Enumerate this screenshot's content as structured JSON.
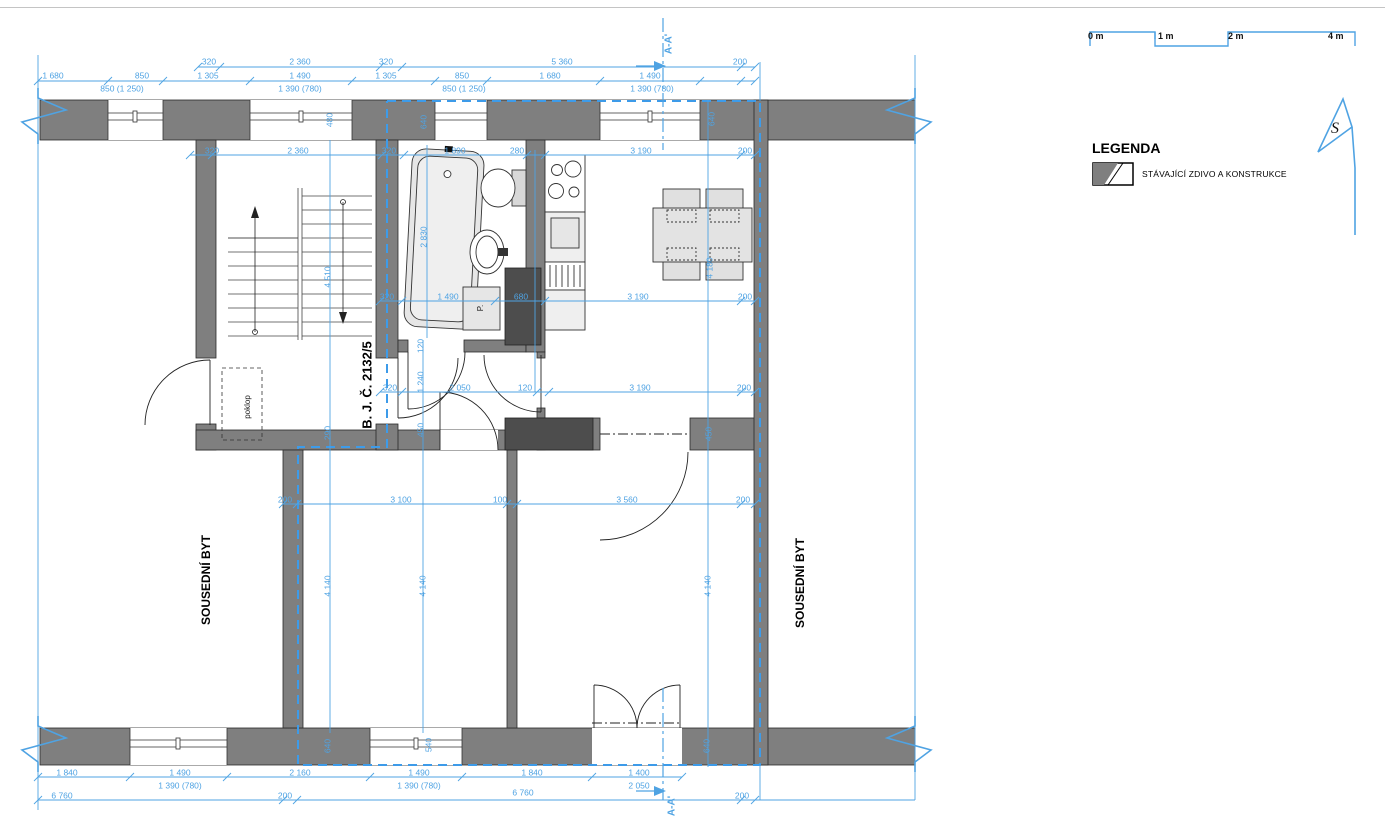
{
  "colors": {
    "dimension": "#4FA3E3",
    "boundary": "#3D9BE9",
    "wall": "#7F7F7F",
    "wall_dark": "#4D4D4D",
    "furniture": "#E6E6E6",
    "line": "#1A1A1A"
  },
  "legend": {
    "title": "LEGENDA",
    "items": [
      {
        "label": "STÁVAJÍCÍ ZDIVO A KONSTRUKCE",
        "swatch": "existing-masonry"
      }
    ]
  },
  "scale_bar": {
    "ticks": [
      "0 m",
      "1 m",
      "2 m",
      "4 m"
    ]
  },
  "north": {
    "label": "S"
  },
  "section_marker": {
    "top": "A-A'",
    "bottom": "A-A'"
  },
  "plan_labels": [
    {
      "id": "unit-number",
      "text": "B. J. Č. 2132/5",
      "x": 368,
      "y": 385,
      "r": -90,
      "size": 13,
      "weight": "bold",
      "color": "#000"
    },
    {
      "id": "neighbor-left",
      "text": "SOUSEDNÍ BYT",
      "x": 207,
      "y": 580,
      "r": -90,
      "size": 12,
      "weight": "bold",
      "color": "#000"
    },
    {
      "id": "neighbor-right",
      "text": "SOUSEDNÍ BYT",
      "x": 801,
      "y": 583,
      "r": -90,
      "size": 12,
      "weight": "bold",
      "color": "#000"
    },
    {
      "id": "hatch",
      "text": "poklop",
      "x": 248,
      "y": 407,
      "r": -90,
      "size": 8,
      "weight": "normal",
      "color": "#222"
    },
    {
      "id": "washing-machine",
      "text": "P.",
      "x": 481,
      "y": 308,
      "r": -90,
      "size": 8,
      "weight": "normal",
      "color": "#222"
    },
    {
      "id": "section-top",
      "text": "A-A'",
      "x": 669,
      "y": 44,
      "r": -90,
      "size": 10,
      "weight": "bold",
      "color": "#4FA3E3"
    },
    {
      "id": "section-bottom",
      "text": "A-A'",
      "x": 672,
      "y": 806,
      "r": -90,
      "size": 10,
      "weight": "bold",
      "color": "#4FA3E3"
    }
  ],
  "dimensions": [
    {
      "t": "320",
      "x": 209,
      "y": 62
    },
    {
      "t": "2 360",
      "x": 300,
      "y": 62
    },
    {
      "t": "320",
      "x": 386,
      "y": 62
    },
    {
      "t": "5 360",
      "x": 562,
      "y": 62
    },
    {
      "t": "200",
      "x": 740,
      "y": 62
    },
    {
      "t": "1 680",
      "x": 53,
      "y": 76
    },
    {
      "t": "850",
      "x": 142,
      "y": 76
    },
    {
      "t": "1 305",
      "x": 208,
      "y": 76
    },
    {
      "t": "1 490",
      "x": 300,
      "y": 76
    },
    {
      "t": "1 305",
      "x": 386,
      "y": 76
    },
    {
      "t": "850",
      "x": 462,
      "y": 76
    },
    {
      "t": "1 680",
      "x": 550,
      "y": 76
    },
    {
      "t": "1 490",
      "x": 650,
      "y": 76
    },
    {
      "t": "850 (1 250)",
      "x": 122,
      "y": 89
    },
    {
      "t": "1 390 (780)",
      "x": 300,
      "y": 89
    },
    {
      "t": "850 (1 250)",
      "x": 464,
      "y": 89
    },
    {
      "t": "1 390 (780)",
      "x": 652,
      "y": 89
    },
    {
      "t": "320",
      "x": 212,
      "y": 151
    },
    {
      "t": "2 360",
      "x": 298,
      "y": 151
    },
    {
      "t": "320",
      "x": 389,
      "y": 151
    },
    {
      "t": "1 890",
      "x": 455,
      "y": 151
    },
    {
      "t": "280",
      "x": 517,
      "y": 151
    },
    {
      "t": "3 190",
      "x": 641,
      "y": 151
    },
    {
      "t": "200",
      "x": 745,
      "y": 151
    },
    {
      "t": "480",
      "x": 330,
      "y": 120,
      "r": -90
    },
    {
      "t": "640",
      "x": 424,
      "y": 122,
      "r": -90
    },
    {
      "t": "640",
      "x": 712,
      "y": 119,
      "r": -90
    },
    {
      "t": "2 830",
      "x": 424,
      "y": 237,
      "r": -90
    },
    {
      "t": "4 510",
      "x": 328,
      "y": 277,
      "r": -90
    },
    {
      "t": "4 180",
      "x": 710,
      "y": 268,
      "r": -90
    },
    {
      "t": "320",
      "x": 387,
      "y": 297
    },
    {
      "t": "1 490",
      "x": 448,
      "y": 297
    },
    {
      "t": "680",
      "x": 521,
      "y": 297
    },
    {
      "t": "3 190",
      "x": 638,
      "y": 297
    },
    {
      "t": "200",
      "x": 745,
      "y": 297
    },
    {
      "t": "120",
      "x": 421,
      "y": 346,
      "r": -90
    },
    {
      "t": "1 240",
      "x": 421,
      "y": 382,
      "r": -90
    },
    {
      "t": "450",
      "x": 421,
      "y": 430,
      "r": -90
    },
    {
      "t": "290",
      "x": 328,
      "y": 433,
      "r": -90
    },
    {
      "t": "320",
      "x": 390,
      "y": 388
    },
    {
      "t": "2 050",
      "x": 460,
      "y": 388
    },
    {
      "t": "120",
      "x": 525,
      "y": 388
    },
    {
      "t": "3 190",
      "x": 640,
      "y": 388
    },
    {
      "t": "200",
      "x": 744,
      "y": 388
    },
    {
      "t": "450",
      "x": 709,
      "y": 434,
      "r": -90
    },
    {
      "t": "200",
      "x": 285,
      "y": 500
    },
    {
      "t": "3 100",
      "x": 401,
      "y": 500
    },
    {
      "t": "100",
      "x": 500,
      "y": 500
    },
    {
      "t": "3 560",
      "x": 627,
      "y": 500
    },
    {
      "t": "200",
      "x": 743,
      "y": 500
    },
    {
      "t": "4 140",
      "x": 328,
      "y": 586,
      "r": -90
    },
    {
      "t": "4 140",
      "x": 423,
      "y": 586,
      "r": -90
    },
    {
      "t": "4 140",
      "x": 708,
      "y": 586,
      "r": -90
    },
    {
      "t": "640",
      "x": 328,
      "y": 746,
      "r": -90
    },
    {
      "t": "540",
      "x": 429,
      "y": 745,
      "r": -90
    },
    {
      "t": "640",
      "x": 707,
      "y": 746,
      "r": -90
    },
    {
      "t": "1 840",
      "x": 67,
      "y": 773
    },
    {
      "t": "1 490",
      "x": 180,
      "y": 773
    },
    {
      "t": "2 160",
      "x": 300,
      "y": 773
    },
    {
      "t": "1 490",
      "x": 419,
      "y": 773
    },
    {
      "t": "1 840",
      "x": 532,
      "y": 773
    },
    {
      "t": "1 400",
      "x": 639,
      "y": 773
    },
    {
      "t": "1 390 (780)",
      "x": 180,
      "y": 786
    },
    {
      "t": "1 390 (780)",
      "x": 419,
      "y": 786
    },
    {
      "t": "2 050",
      "x": 639,
      "y": 786
    },
    {
      "t": "6 760",
      "x": 62,
      "y": 796
    },
    {
      "t": "200",
      "x": 285,
      "y": 796
    },
    {
      "t": "6 760",
      "x": 523,
      "y": 793
    },
    {
      "t": "200",
      "x": 742,
      "y": 796
    }
  ]
}
